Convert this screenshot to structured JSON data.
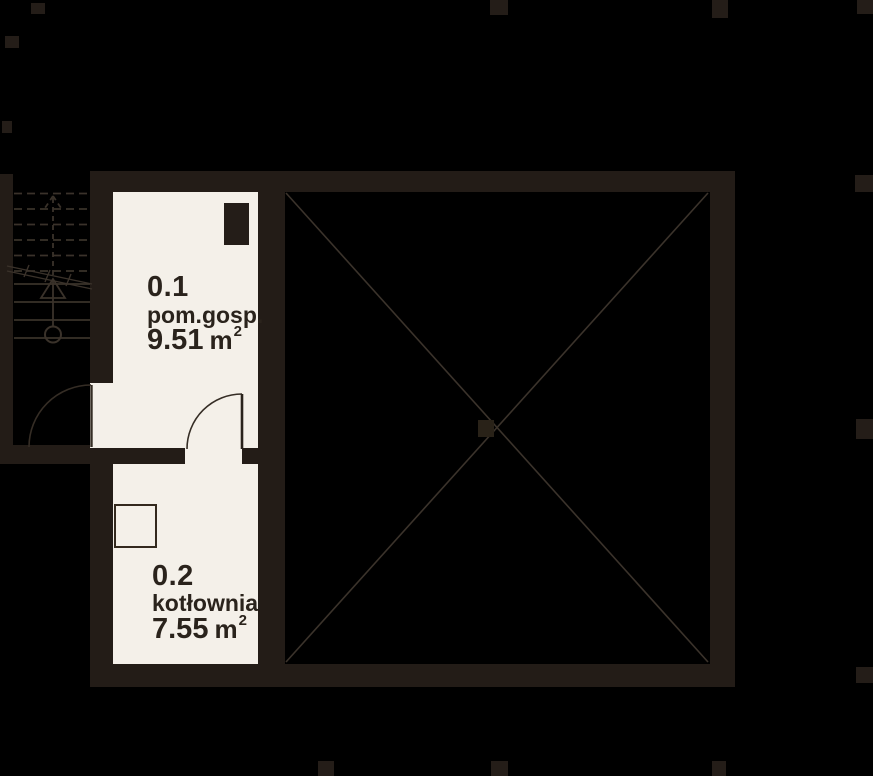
{
  "plan_title": "basement floor plan",
  "rooms": [
    {
      "number": "0.1",
      "name": "pom.gosp.",
      "area_value": "9.51",
      "area_unit": "m",
      "area_exponent": "2"
    },
    {
      "number": "0.2",
      "name": "kotłownia",
      "area_value": "7.55",
      "area_unit": "m",
      "area_exponent": "2"
    }
  ],
  "colors": {
    "background": "#000000",
    "wall": "#231c17",
    "floor": "#f4f0e9",
    "line": "#3a322a",
    "text": "#2a231c"
  }
}
